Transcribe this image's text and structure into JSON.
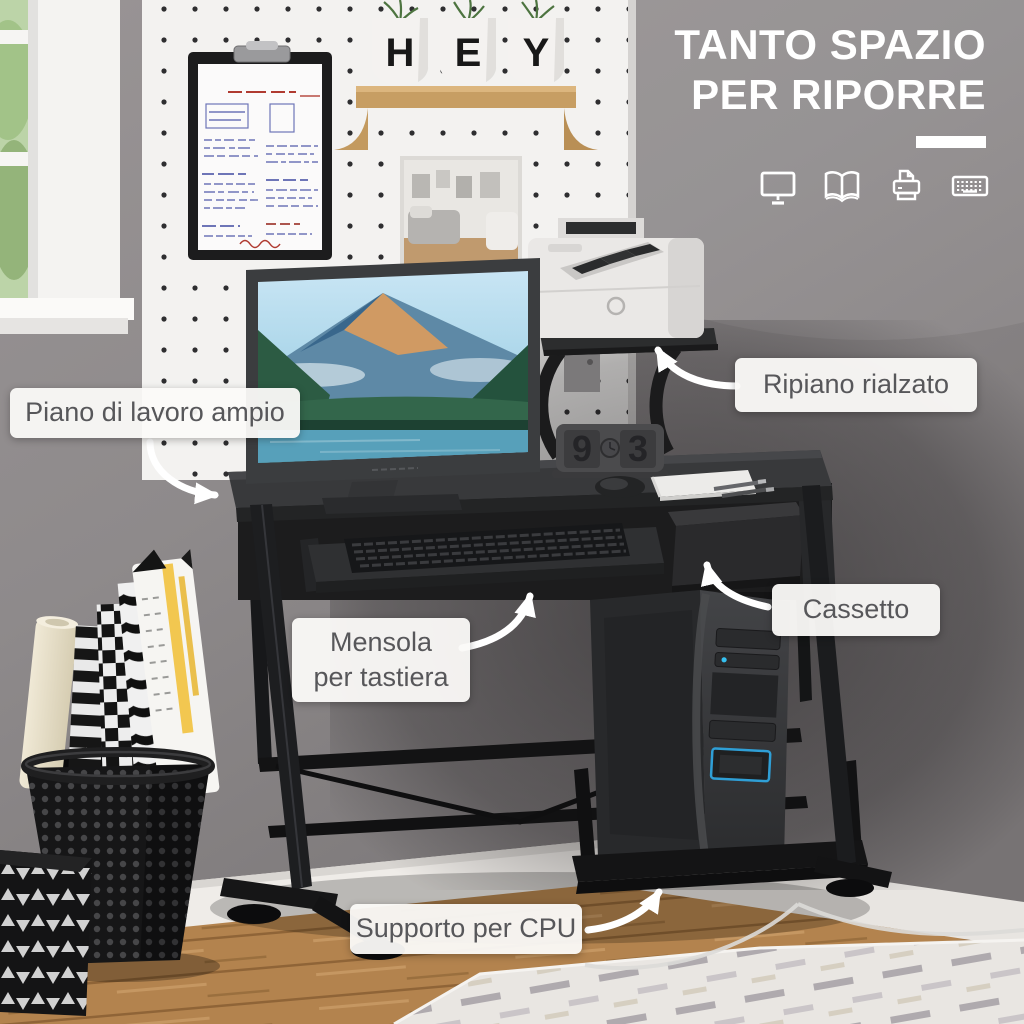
{
  "title": {
    "line1": "TANTO SPAZIO",
    "line2": "PER RIPORRE"
  },
  "feature_icons": [
    {
      "name": "monitor-icon"
    },
    {
      "name": "book-icon"
    },
    {
      "name": "printer-icon"
    },
    {
      "name": "keyboard-icon"
    }
  ],
  "callouts": {
    "worktop": "Piano di lavoro ampio",
    "raised_shelf": "Ripiano rialzato",
    "drawer": "Cassetto",
    "keyboard_shelf": [
      "Mensola",
      "per tastiera"
    ],
    "cpu_stand": "Supporto per CPU"
  },
  "scene": {
    "planter_letters": [
      "H",
      "E",
      "Y"
    ],
    "clock_digits": [
      "9",
      "3"
    ],
    "colors": {
      "callout_bg": "#faf9f7",
      "callout_text": "#57575a",
      "title_text": "#ffffff",
      "accent_blue": "#2f9fd6",
      "desk_black": "#2b2c2e",
      "wall_gray": "#8f8b8d",
      "pegboard_white": "#f3f2f0",
      "wood_floor": "#b5854f"
    }
  }
}
